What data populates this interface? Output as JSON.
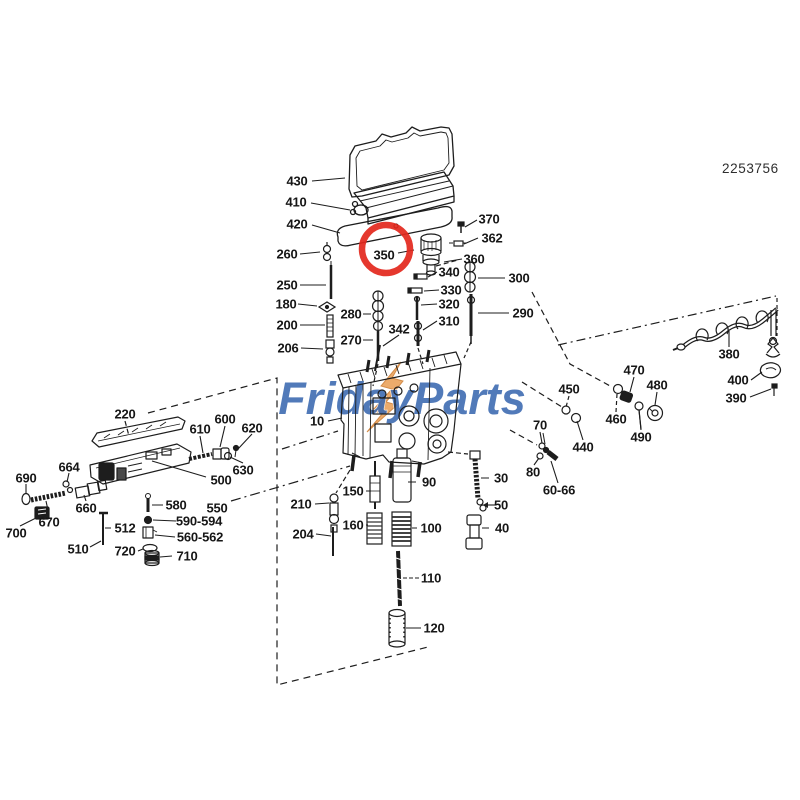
{
  "header": {
    "part_number": "2253756"
  },
  "watermark": {
    "text": "FridayParts",
    "color": "#3a68b0",
    "accent_color": "#e9a15c"
  },
  "highlight": {
    "label": "350",
    "color": "#e3271c",
    "shape": "circle"
  },
  "colors": {
    "background": "#ffffff",
    "ink": "#1d1d1d",
    "highlight_red": "#e3271c",
    "watermark_blue": "#3a68b0",
    "watermark_orange": "#e9a15c"
  },
  "callouts": [
    {
      "label": "430",
      "x": 297,
      "y": 181
    },
    {
      "label": "410",
      "x": 296,
      "y": 202
    },
    {
      "label": "420",
      "x": 297,
      "y": 224
    },
    {
      "label": "370",
      "x": 489,
      "y": 219
    },
    {
      "label": "362",
      "x": 492,
      "y": 238
    },
    {
      "label": "350",
      "x": 384,
      "y": 255,
      "highlighted": true
    },
    {
      "label": "360",
      "x": 474,
      "y": 259
    },
    {
      "label": "340",
      "x": 449,
      "y": 272
    },
    {
      "label": "330",
      "x": 451,
      "y": 290
    },
    {
      "label": "320",
      "x": 449,
      "y": 304
    },
    {
      "label": "310",
      "x": 449,
      "y": 321
    },
    {
      "label": "300",
      "x": 519,
      "y": 278
    },
    {
      "label": "290",
      "x": 523,
      "y": 313
    },
    {
      "label": "260",
      "x": 287,
      "y": 254
    },
    {
      "label": "250",
      "x": 287,
      "y": 285
    },
    {
      "label": "180",
      "x": 286,
      "y": 304
    },
    {
      "label": "200",
      "x": 287,
      "y": 325
    },
    {
      "label": "206",
      "x": 288,
      "y": 348
    },
    {
      "label": "280",
      "x": 351,
      "y": 314
    },
    {
      "label": "270",
      "x": 351,
      "y": 340
    },
    {
      "label": "342",
      "x": 399,
      "y": 329
    },
    {
      "label": "10",
      "x": 317,
      "y": 421
    },
    {
      "label": "220",
      "x": 125,
      "y": 414
    },
    {
      "label": "610",
      "x": 200,
      "y": 429
    },
    {
      "label": "600",
      "x": 225,
      "y": 419
    },
    {
      "label": "620",
      "x": 252,
      "y": 428
    },
    {
      "label": "630",
      "x": 243,
      "y": 470
    },
    {
      "label": "500",
      "x": 221,
      "y": 480
    },
    {
      "label": "664",
      "x": 69,
      "y": 467
    },
    {
      "label": "690",
      "x": 26,
      "y": 478
    },
    {
      "label": "660",
      "x": 86,
      "y": 508
    },
    {
      "label": "670",
      "x": 49,
      "y": 522
    },
    {
      "label": "700",
      "x": 16,
      "y": 533
    },
    {
      "label": "580",
      "x": 176,
      "y": 505
    },
    {
      "label": "550",
      "x": 217,
      "y": 508
    },
    {
      "label": "590-594",
      "x": 199,
      "y": 521
    },
    {
      "label": "512",
      "x": 125,
      "y": 528
    },
    {
      "label": "560-562",
      "x": 200,
      "y": 537
    },
    {
      "label": "510",
      "x": 78,
      "y": 549
    },
    {
      "label": "720",
      "x": 125,
      "y": 551
    },
    {
      "label": "710",
      "x": 187,
      "y": 556
    },
    {
      "label": "450",
      "x": 569,
      "y": 389
    },
    {
      "label": "470",
      "x": 634,
      "y": 370
    },
    {
      "label": "480",
      "x": 657,
      "y": 385
    },
    {
      "label": "460",
      "x": 616,
      "y": 419
    },
    {
      "label": "490",
      "x": 641,
      "y": 437
    },
    {
      "label": "440",
      "x": 583,
      "y": 447
    },
    {
      "label": "70",
      "x": 540,
      "y": 425
    },
    {
      "label": "80",
      "x": 533,
      "y": 472
    },
    {
      "label": "60-66",
      "x": 559,
      "y": 490
    },
    {
      "label": "380",
      "x": 729,
      "y": 354
    },
    {
      "label": "400",
      "x": 738,
      "y": 380
    },
    {
      "label": "390",
      "x": 736,
      "y": 398
    },
    {
      "label": "210",
      "x": 301,
      "y": 504
    },
    {
      "label": "150",
      "x": 353,
      "y": 491
    },
    {
      "label": "90",
      "x": 429,
      "y": 482
    },
    {
      "label": "30",
      "x": 501,
      "y": 478
    },
    {
      "label": "50",
      "x": 501,
      "y": 505
    },
    {
      "label": "40",
      "x": 502,
      "y": 528
    },
    {
      "label": "160",
      "x": 353,
      "y": 525
    },
    {
      "label": "100",
      "x": 431,
      "y": 528
    },
    {
      "label": "204",
      "x": 303,
      "y": 534
    },
    {
      "label": "110",
      "x": 431,
      "y": 578
    },
    {
      "label": "120",
      "x": 434,
      "y": 628
    }
  ]
}
